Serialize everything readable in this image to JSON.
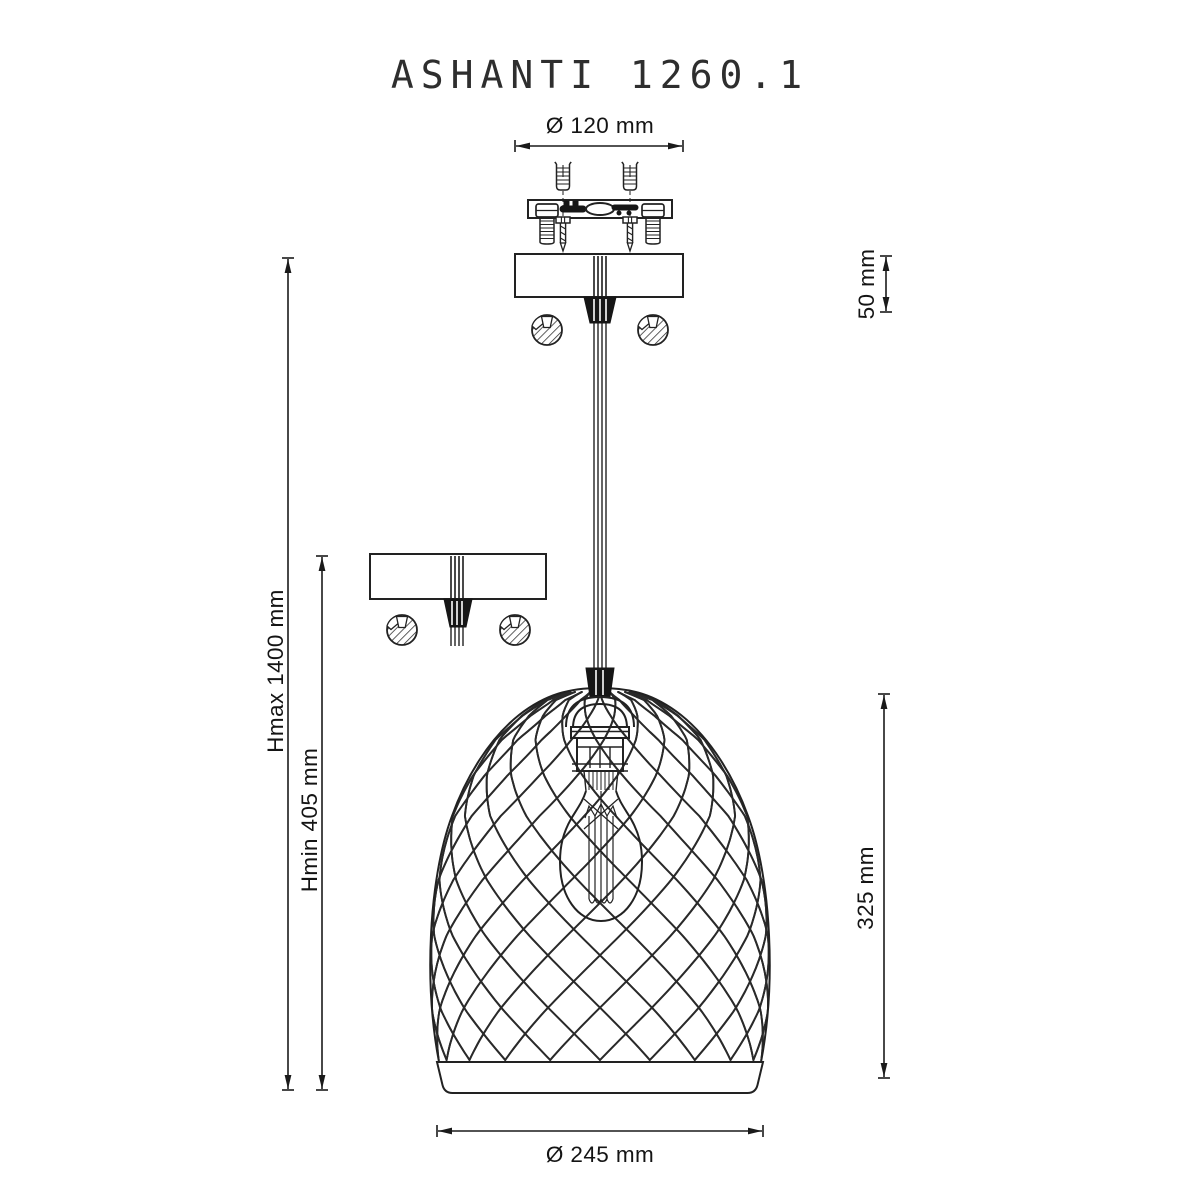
{
  "title": "ASHANTI 1260.1",
  "dims": {
    "canopy_diameter": "Ø 120 mm",
    "canopy_height": "50 mm",
    "height_max": "Hmax 1400 mm",
    "height_min": "Hmin 405 mm",
    "shade_height": "325 mm",
    "shade_diameter": "Ø 245 mm"
  },
  "colors": {
    "line": "#222222",
    "dimension": "#1a1a1a",
    "background": "#ffffff"
  }
}
